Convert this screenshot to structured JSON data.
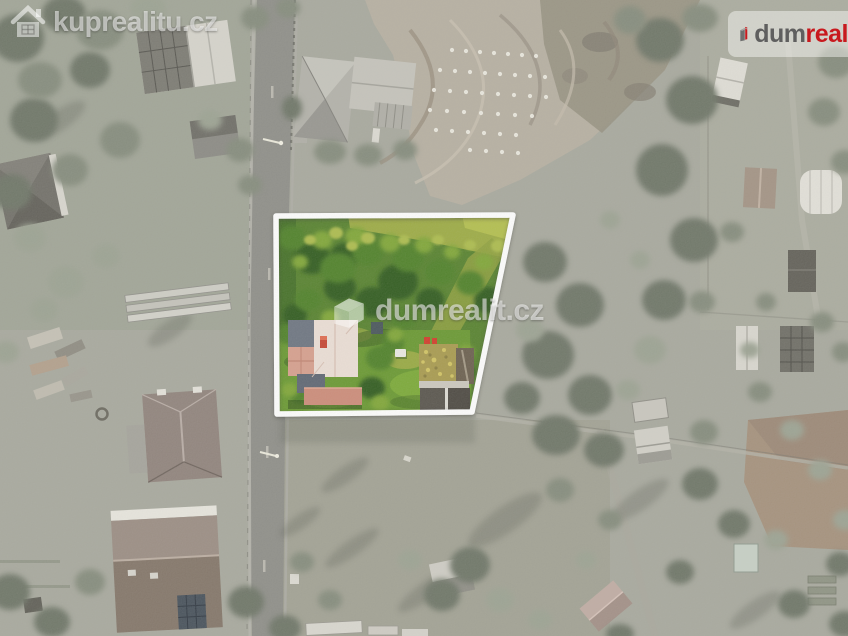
{
  "watermarks": {
    "top_left": {
      "text": "kuprealitu.cz",
      "icon": "house-icon"
    },
    "center": {
      "text": "dumrealit.cz",
      "icon": "building-3d-icon"
    }
  },
  "logo": {
    "part_gray": "dum",
    "part_red": "real",
    "icon": "building-i-icon"
  },
  "colors": {
    "logo_red": "#c8191e",
    "logo_gray": "#5f5f5f",
    "parcel_border": "#ffffff"
  }
}
